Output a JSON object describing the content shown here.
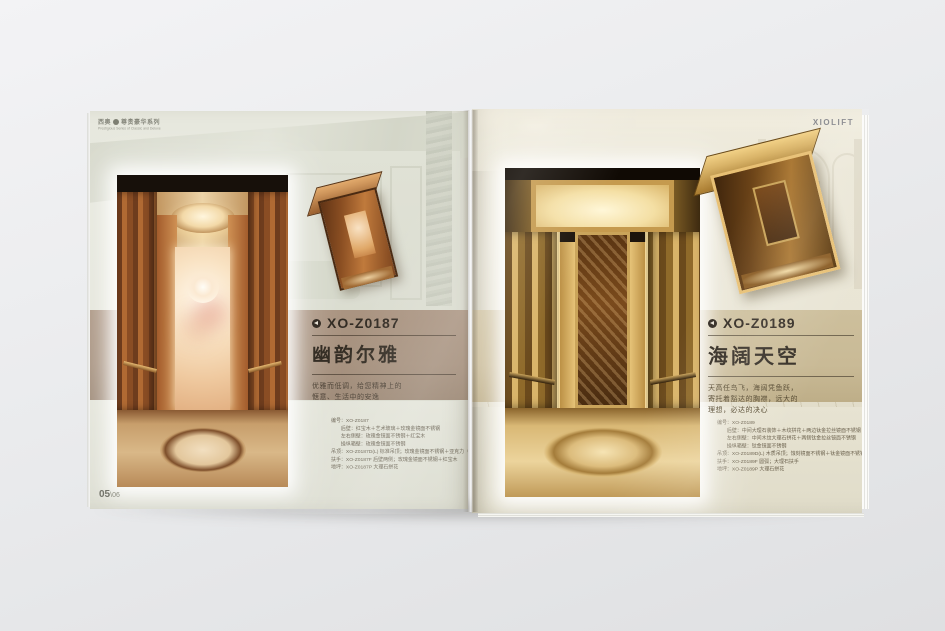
{
  "header": {
    "series_logo": "西奥",
    "series_name": "尊贵豪华系列",
    "series_tagline": "Prestigious Series of Classic and Deluxe",
    "brand_logo": "XIOLIFT"
  },
  "left_page": {
    "model": "XO-Z0187",
    "name": "幽韵尔雅",
    "description": [
      "优雅而低调，给您精神上的",
      "惬意、生活中的安逸"
    ],
    "specs": [
      "编号：XO-Z0187",
      "后壁：红宝木＋艺术玻璃＋玫瑰金镜面不锈钢",
      "左右侧壁：玫瑰金镜面不锈钢＋红宝木",
      "操纵箱壁：玫瑰金镜面不锈钢",
      "吊顶：XO-Z0187D(L) 标准吊顶；玫瑰金镜面不锈钢＋亚克力（透光）",
      "扶手：XO-Z0187F 后壁两侧；玫瑰金镜面不锈钢＋红宝木",
      "地坪：XO-Z0187P 大理石拼花"
    ]
  },
  "right_page": {
    "model": "XO-Z0189",
    "name": "海阔天空",
    "description": [
      "天高任鸟飞，海阔凭鱼跃，",
      "寄托着豁达的胸襟，远大的",
      "理想，必达的决心"
    ],
    "specs": [
      "编号：XO-Z0189",
      "后壁：中间大理石装饰＋木纹拼花＋两边钛金拉丝镜面不锈钢",
      "左右侧壁：中间木纹大理石拼花＋两侧钛金拉丝镜面不锈钢",
      "操纵箱壁：钛金镜面不锈钢",
      "吊顶：XO-Z0189D(L) 木质吊顶；蚀刻镜面不锈钢＋钛金镜面不锈钢＋亚克力",
      "扶手：XO-Z0189F 圆弧；大理石扶手",
      "地坪：XO-Z0189P 大理石拼花"
    ]
  },
  "footer": {
    "page_number": "05",
    "page_number_sub": "\\06"
  },
  "colors": {
    "left_band": "#a6917e",
    "right_band": "#c9ba96",
    "left_page": "#e6e7dd",
    "right_page": "#e9e4d4",
    "backdrop": "#e9eaec"
  }
}
